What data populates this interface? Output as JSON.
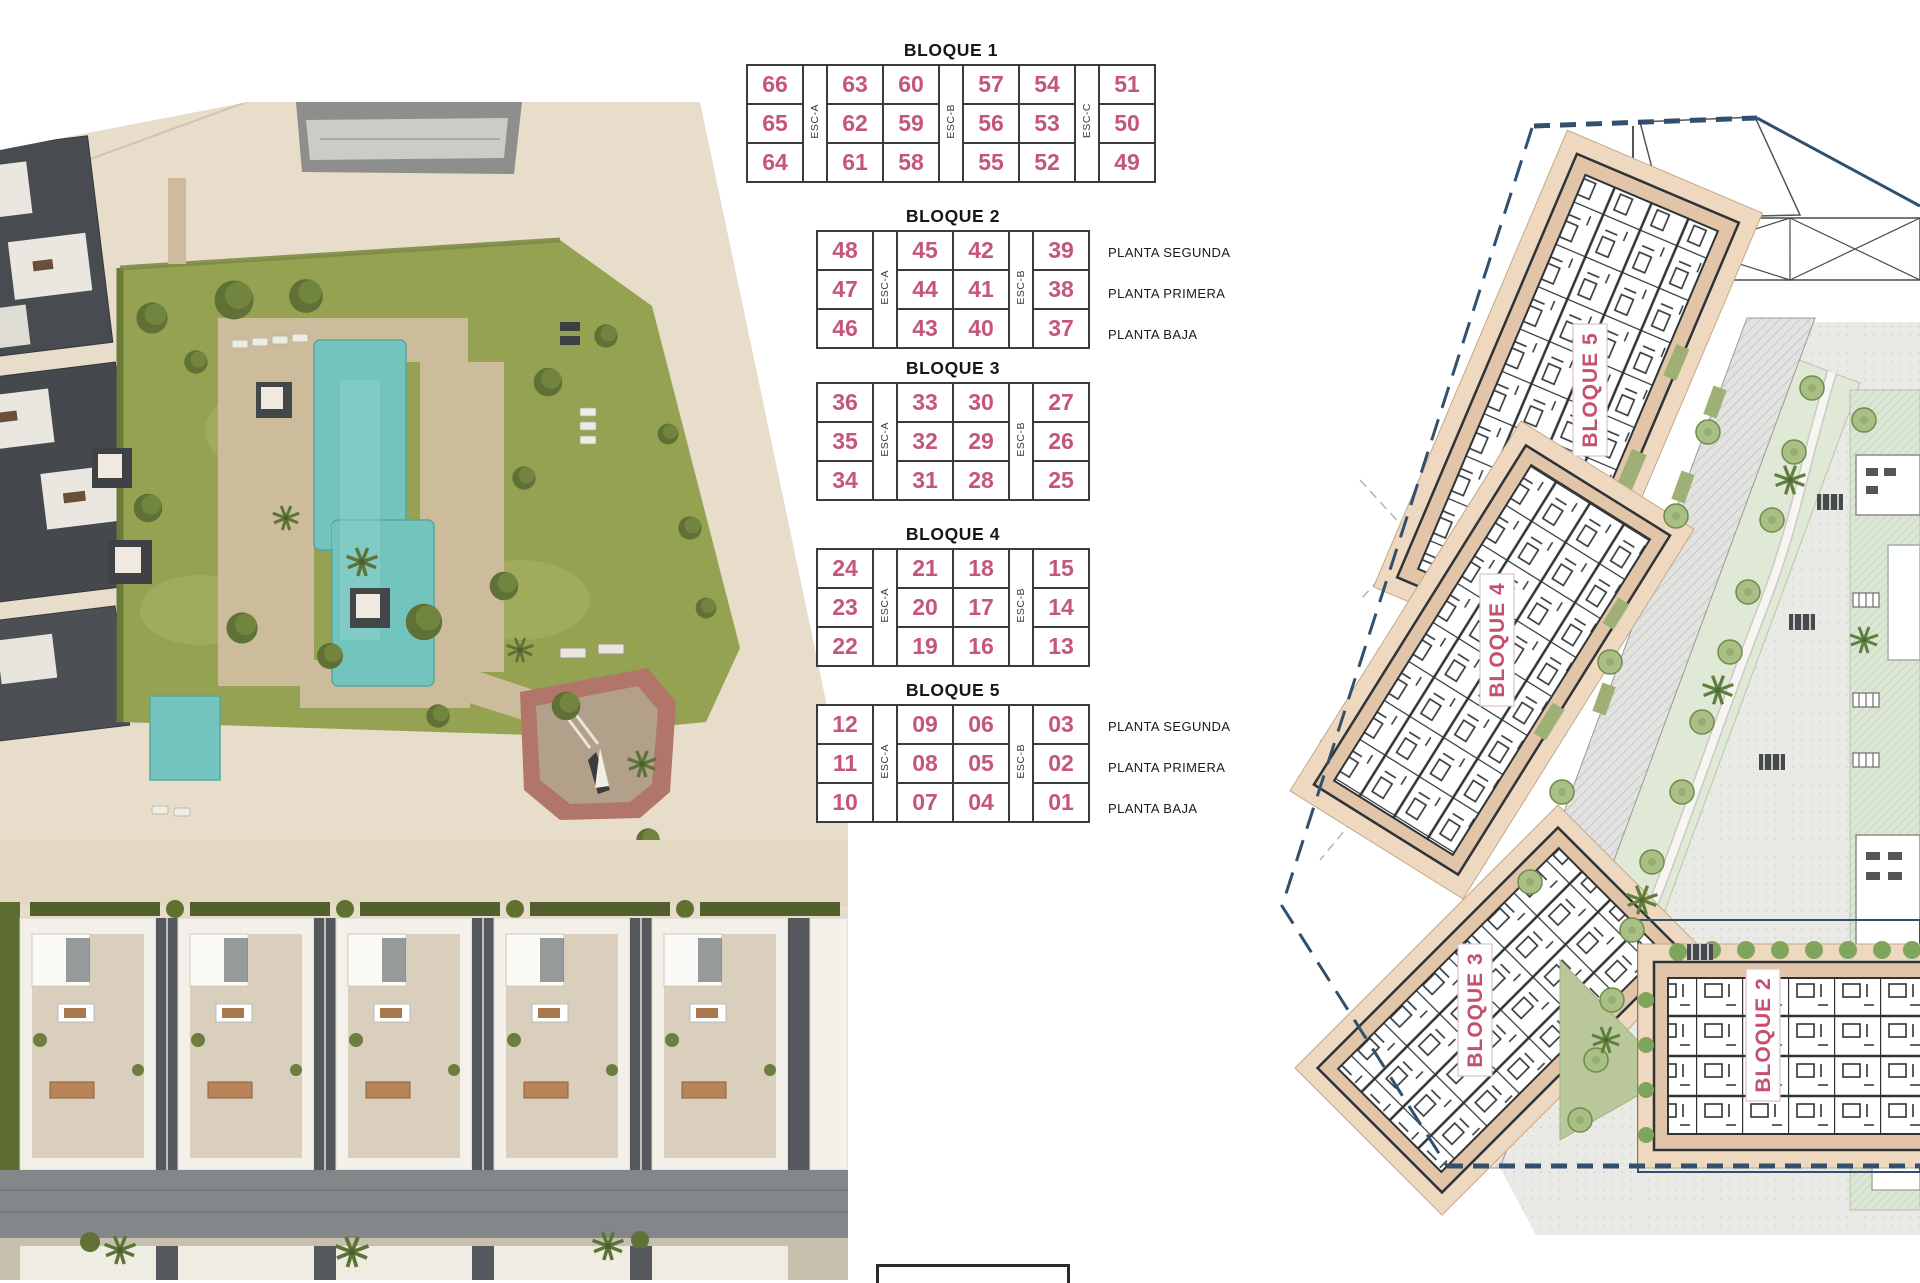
{
  "unit_tables": [
    {
      "title": "BLOQUE 1",
      "esc": [
        "ESC-A",
        "ESC-B",
        "ESC-C"
      ],
      "columns": [
        [
          "66",
          "65",
          "64"
        ],
        [
          "63",
          "62",
          "61"
        ],
        [
          "60",
          "59",
          "58"
        ],
        [
          "57",
          "56",
          "55"
        ],
        [
          "54",
          "53",
          "52"
        ],
        [
          "51",
          "50",
          "49"
        ]
      ],
      "floor_labels": null
    },
    {
      "title": "BLOQUE 2",
      "esc": [
        "ESC-A",
        "ESC-B"
      ],
      "columns": [
        [
          "48",
          "47",
          "46"
        ],
        [
          "45",
          "44",
          "43"
        ],
        [
          "42",
          "41",
          "40"
        ],
        [
          "39",
          "38",
          "37"
        ]
      ],
      "floor_labels": [
        "PLANTA SEGUNDA",
        "PLANTA PRIMERA",
        "PLANTA BAJA"
      ]
    },
    {
      "title": "BLOQUE 3",
      "esc": [
        "ESC-A",
        "ESC-B"
      ],
      "columns": [
        [
          "36",
          "35",
          "34"
        ],
        [
          "33",
          "32",
          "31"
        ],
        [
          "30",
          "29",
          "28"
        ],
        [
          "27",
          "26",
          "25"
        ]
      ],
      "floor_labels": null
    },
    {
      "title": "BLOQUE 4",
      "esc": [
        "ESC-A",
        "ESC-B"
      ],
      "columns": [
        [
          "24",
          "23",
          "22"
        ],
        [
          "21",
          "20",
          "19"
        ],
        [
          "18",
          "17",
          "16"
        ],
        [
          "15",
          "14",
          "13"
        ]
      ],
      "floor_labels": null
    },
    {
      "title": "BLOQUE 5",
      "esc": [
        "ESC-A",
        "ESC-B"
      ],
      "columns": [
        [
          "12",
          "11",
          "10"
        ],
        [
          "09",
          "08",
          "07"
        ],
        [
          "06",
          "05",
          "04"
        ],
        [
          "03",
          "02",
          "01"
        ]
      ],
      "floor_labels": [
        "PLANTA SEGUNDA",
        "PLANTA PRIMERA",
        "PLANTA BAJA"
      ]
    }
  ],
  "plan": {
    "labels": [
      "BLOQUE 5",
      "BLOQUE 4",
      "BLOQUE 3",
      "BLOQUE 2"
    ]
  },
  "colors": {
    "unit_number_pink": "#c4557d",
    "table_border": "#3b3b3b",
    "boundary_navy": "#31506e",
    "pool_turquoise": "#73c4be",
    "lawn_green": "#95a251",
    "plan_building_tan": "#e2c5a8",
    "plan_terrace_tan": "#eed9c0",
    "ground_beige": "#e7ddca"
  }
}
